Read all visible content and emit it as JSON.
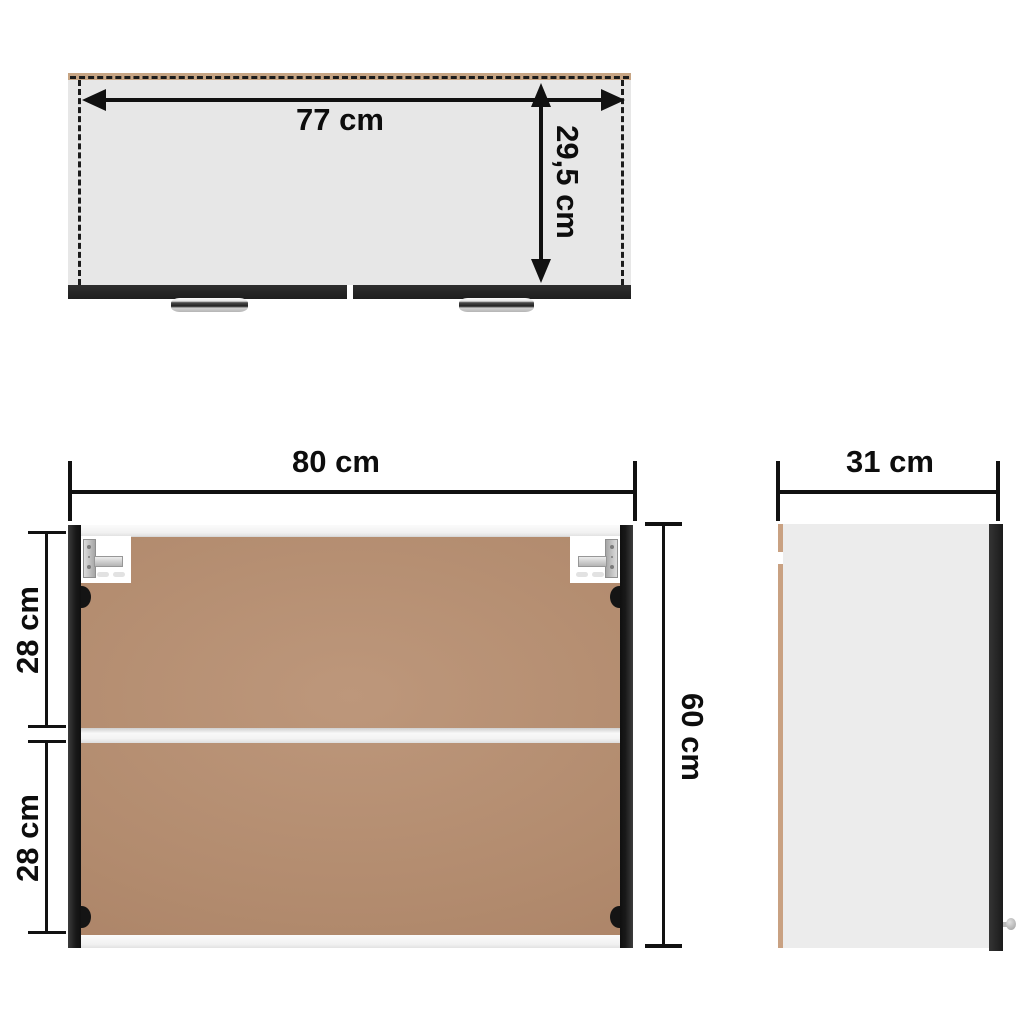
{
  "diagram_title": "wall-cabinet-dimension-diagram",
  "colors": {
    "dimension_ink": "#111111",
    "top_view_body_gray": "#e7e7e7",
    "panel_black": "#1f1f1f",
    "interior_brown": "#b28b6e",
    "back_panel_tan": "#c9a182",
    "shelf_white": "#f3f3f3",
    "background": "#ffffff"
  },
  "top_view": {
    "width_label": "77 cm",
    "depth_label": "29,5 cm"
  },
  "front_view": {
    "width_label": "80 cm",
    "height_label": "60 cm",
    "upper_compartment_label": "28 cm",
    "lower_compartment_label": "28 cm"
  },
  "side_view": {
    "depth_label": "31 cm"
  }
}
